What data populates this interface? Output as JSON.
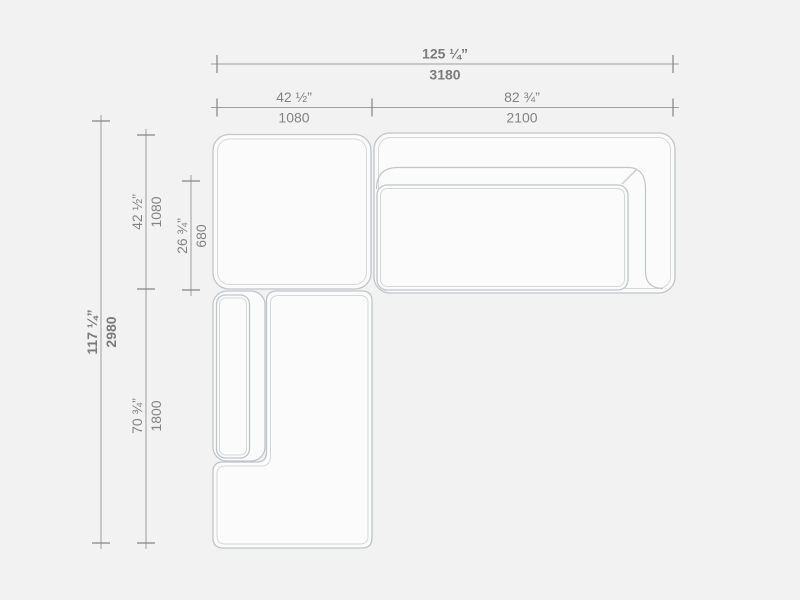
{
  "dims": {
    "overall_width": {
      "in": "125 ¼”",
      "mm": "3180"
    },
    "left_width": {
      "in": "42 ½”",
      "mm": "1080"
    },
    "right_width": {
      "in": "82 ¾”",
      "mm": "2100"
    },
    "overall_depth": {
      "in": "117 ¼”",
      "mm": "2980"
    },
    "upper_depth": {
      "in": "42 ½”",
      "mm": "1080"
    },
    "cushion_depth": {
      "in": "26 ¾”",
      "mm": "680"
    },
    "chaise_length": {
      "in": "70 ¾”",
      "mm": "1800"
    }
  },
  "colors": {
    "background": "#f2f2f2",
    "piece_fill": "#fbfbfb",
    "outline": "#c1c5c7",
    "outline_inner": "#d5d8d9",
    "dimension_line": "#9e9e9e",
    "tick": "#858585",
    "text": "#838383"
  }
}
